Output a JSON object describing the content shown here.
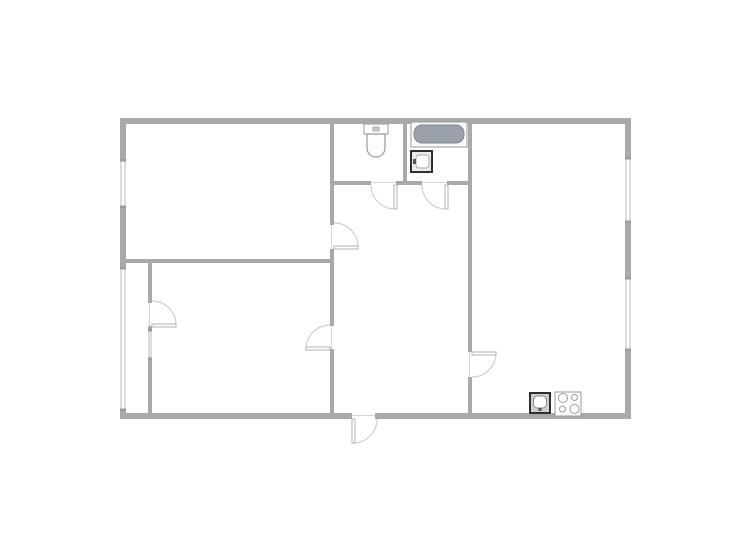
{
  "floorplan": {
    "canvas": {
      "width": 750,
      "height": 557
    },
    "colors": {
      "background": "#ffffff",
      "wall": "#a9a9a9",
      "wall_cap": "#9c9c9c",
      "window_line": "#b9b9b9",
      "door_arc": "#c8c8c8",
      "door_leaf_fill": "#ffffff",
      "door_leaf_border": "#b2b2b2",
      "threshold": "#d6d6d6",
      "fixture_outline": "#9a9a9a",
      "fixture_dark": "#2f2f2f",
      "tub_fill": "#9aa1ab",
      "tub_border": "#81888f",
      "white": "#ffffff"
    },
    "rooms": [
      {
        "name": "room-top-left",
        "x": 126,
        "y": 124,
        "w": 204,
        "h": 135
      },
      {
        "name": "room-bottom-left",
        "x": 152,
        "y": 263,
        "w": 178,
        "h": 150
      },
      {
        "name": "balcony",
        "x": 126,
        "y": 263,
        "w": 22,
        "h": 150
      },
      {
        "name": "wc",
        "x": 334,
        "y": 124,
        "w": 69,
        "h": 57
      },
      {
        "name": "bathroom",
        "x": 407,
        "y": 124,
        "w": 61,
        "h": 57
      },
      {
        "name": "hallway",
        "x": 334,
        "y": 185,
        "w": 134,
        "h": 228
      },
      {
        "name": "room-right",
        "x": 472,
        "y": 124,
        "w": 153,
        "h": 289
      }
    ],
    "walls": [
      {
        "x": 120,
        "y": 118,
        "w": 511,
        "h": 6
      },
      {
        "x": 120,
        "y": 413,
        "w": 232,
        "h": 6
      },
      {
        "x": 375,
        "y": 413,
        "w": 256,
        "h": 6
      },
      {
        "x": 120,
        "y": 124,
        "w": 6,
        "h": 36
      },
      {
        "x": 120,
        "y": 207,
        "w": 6,
        "h": 61
      },
      {
        "x": 120,
        "y": 410,
        "w": 6,
        "h": 3
      },
      {
        "x": 625,
        "y": 124,
        "w": 6,
        "h": 34
      },
      {
        "x": 625,
        "y": 222,
        "w": 6,
        "h": 56
      },
      {
        "x": 625,
        "y": 350,
        "w": 6,
        "h": 63
      },
      {
        "x": 330,
        "y": 124,
        "w": 4,
        "h": 101
      },
      {
        "x": 330,
        "y": 249,
        "w": 4,
        "h": 77
      },
      {
        "x": 330,
        "y": 349,
        "w": 4,
        "h": 64
      },
      {
        "x": 126,
        "y": 259,
        "w": 204,
        "h": 4
      },
      {
        "x": 148,
        "y": 263,
        "w": 4,
        "h": 40
      },
      {
        "x": 148,
        "y": 326,
        "w": 4,
        "h": 4
      },
      {
        "x": 148,
        "y": 359,
        "w": 4,
        "h": 54
      },
      {
        "x": 334,
        "y": 181,
        "w": 37,
        "h": 4
      },
      {
        "x": 396,
        "y": 181,
        "w": 26,
        "h": 4
      },
      {
        "x": 447,
        "y": 181,
        "w": 21,
        "h": 4
      },
      {
        "x": 403,
        "y": 124,
        "w": 4,
        "h": 57
      },
      {
        "x": 468,
        "y": 124,
        "w": 4,
        "h": 228
      },
      {
        "x": 468,
        "y": 377,
        "w": 4,
        "h": 36
      }
    ],
    "windows": [
      {
        "name": "window-left-top",
        "x": 120,
        "y": 160,
        "w": 6,
        "h": 47,
        "o": "v"
      },
      {
        "name": "window-balcony-glazing",
        "x": 120,
        "y": 268,
        "w": 6,
        "h": 142,
        "o": "v"
      },
      {
        "name": "window-right-top",
        "x": 625,
        "y": 158,
        "w": 6,
        "h": 64,
        "o": "v"
      },
      {
        "name": "window-right-bottom",
        "x": 625,
        "y": 278,
        "w": 6,
        "h": 72,
        "o": "v"
      },
      {
        "name": "window-balcony-partition",
        "x": 148,
        "y": 330,
        "w": 4,
        "h": 29,
        "o": "v"
      }
    ],
    "doors": [
      {
        "name": "door-room-top-left",
        "threshold": {
          "x": 331,
          "y": 225,
          "w": 1,
          "h": 24
        },
        "leaf": {
          "x": 334,
          "y": 246,
          "w": 24,
          "h": 3
        },
        "arc": {
          "sx": 358,
          "sy": 247,
          "ex": 334,
          "ey": 223,
          "r": 24,
          "sweep": 0
        }
      },
      {
        "name": "door-room-bottom-left",
        "threshold": {
          "x": 331,
          "y": 326,
          "w": 1,
          "h": 23
        },
        "leaf": {
          "x": 306,
          "y": 347,
          "w": 24,
          "h": 3
        },
        "arc": {
          "sx": 306,
          "sy": 348,
          "ex": 330,
          "ey": 325,
          "r": 24,
          "sweep": 1
        }
      },
      {
        "name": "door-balcony",
        "threshold": {
          "x": 149,
          "y": 303,
          "w": 1,
          "h": 23
        },
        "leaf": {
          "x": 152,
          "y": 324,
          "w": 24,
          "h": 3
        },
        "arc": {
          "sx": 176,
          "sy": 325,
          "ex": 152,
          "ey": 301,
          "r": 24,
          "sweep": 0
        }
      },
      {
        "name": "door-wc",
        "threshold": {
          "x": 371,
          "y": 182,
          "w": 25,
          "h": 1
        },
        "leaf": {
          "x": 394,
          "y": 185,
          "w": 3,
          "h": 24
        },
        "arc": {
          "sx": 395,
          "sy": 209,
          "ex": 371,
          "ey": 185,
          "r": 24,
          "sweep": 1
        }
      },
      {
        "name": "door-bathroom",
        "threshold": {
          "x": 422,
          "y": 182,
          "w": 25,
          "h": 1
        },
        "leaf": {
          "x": 445,
          "y": 185,
          "w": 3,
          "h": 24
        },
        "arc": {
          "sx": 446,
          "sy": 209,
          "ex": 422,
          "ey": 185,
          "r": 24,
          "sweep": 1
        }
      },
      {
        "name": "door-room-right",
        "threshold": {
          "x": 469,
          "y": 352,
          "w": 1,
          "h": 25
        },
        "leaf": {
          "x": 472,
          "y": 352,
          "w": 24,
          "h": 3
        },
        "arc": {
          "sx": 496,
          "sy": 353,
          "ex": 472,
          "ey": 377,
          "r": 24,
          "sweep": 1
        }
      },
      {
        "name": "door-entry",
        "threshold": {
          "x": 352,
          "y": 415,
          "w": 23,
          "h": 1
        },
        "leaf": {
          "x": 352,
          "y": 419,
          "w": 3,
          "h": 24
        },
        "arc": {
          "sx": 353,
          "sy": 443,
          "ex": 377,
          "ey": 419,
          "r": 24,
          "sweep": 0
        }
      }
    ],
    "fixtures": [
      {
        "type": "toilet",
        "name": "toilet-icon",
        "tank": {
          "x": 364,
          "y": 124,
          "w": 24,
          "h": 10
        },
        "bowl": {
          "x": 367,
          "y": 134,
          "w": 18,
          "h": 23
        }
      },
      {
        "type": "bathtub",
        "name": "bathtub-icon",
        "outer": {
          "x": 411,
          "y": 122,
          "w": 56,
          "h": 25
        },
        "inner": {
          "x": 414,
          "y": 125,
          "w": 50,
          "h": 18
        }
      },
      {
        "type": "washbasin",
        "name": "bathroom-sink-icon",
        "box": {
          "x": 411,
          "y": 151,
          "w": 21,
          "h": 21
        }
      },
      {
        "type": "kitchen_sink",
        "name": "kitchen-sink-icon",
        "box": {
          "x": 530,
          "y": 393,
          "w": 20,
          "h": 20
        }
      },
      {
        "type": "stove",
        "name": "stove-icon",
        "box": {
          "x": 555,
          "y": 392,
          "w": 26,
          "h": 24
        },
        "burners": [
          {
            "cx": 563,
            "cy": 398,
            "r": 4.5
          },
          {
            "cx": 574.5,
            "cy": 397.5,
            "r": 3
          },
          {
            "cx": 562.5,
            "cy": 409,
            "r": 3
          },
          {
            "cx": 574.5,
            "cy": 409,
            "r": 4.5
          }
        ]
      }
    ]
  }
}
